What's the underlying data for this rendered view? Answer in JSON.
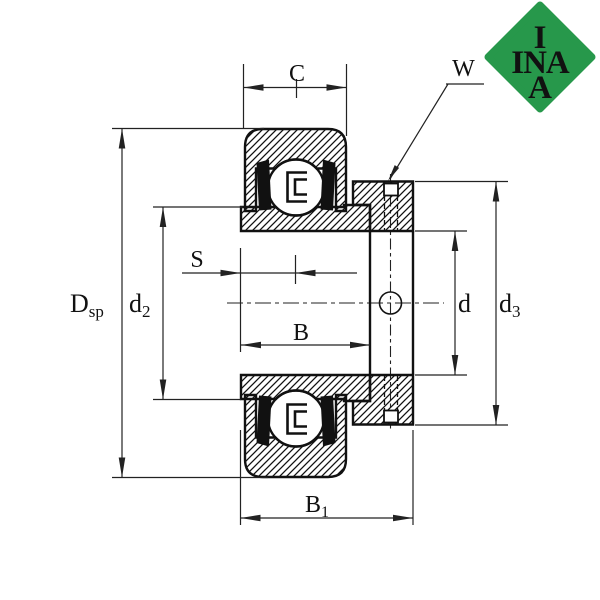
{
  "logo": {
    "top": "I",
    "middle": "INA",
    "bottom": "A"
  },
  "labels": {
    "c": "C",
    "w": "W",
    "s": "S",
    "b": "B",
    "b1_main": "B",
    "b1_sub": "1",
    "dsp_main": "D",
    "dsp_sub": "sp",
    "d2_main": "d",
    "d2_sub": "2",
    "d_bore": "d",
    "d3_main": "d",
    "d3_sub": "3"
  },
  "colors": {
    "background": "#ffffff",
    "ink": "#111111",
    "dimension_line": "#222222",
    "logo_green": "#27984b",
    "logo_text": "#ffffff"
  }
}
